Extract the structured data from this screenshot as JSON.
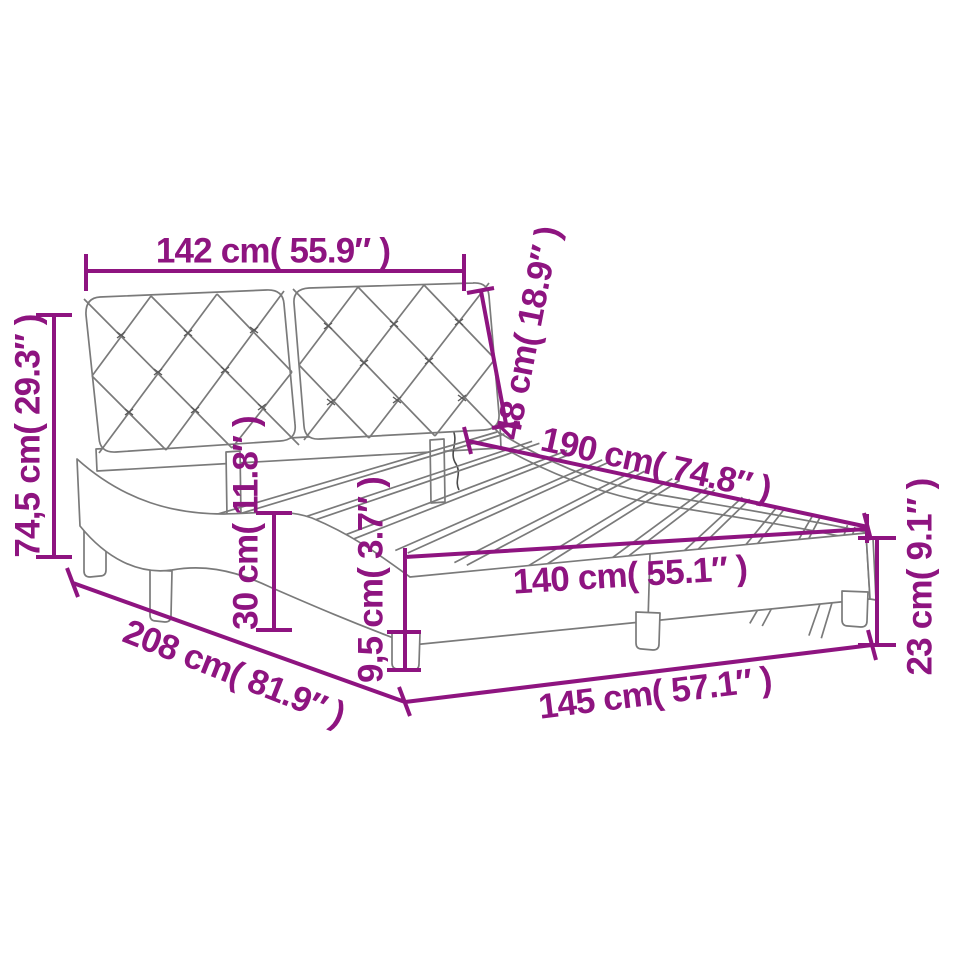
{
  "diagram": {
    "type": "furniture-dimension-diagram",
    "subject": "upholstered bed frame with two tufted headboard cushions, curved side rails, slatted base and legs",
    "accent_color": "#8e1480",
    "line_art_color": "#7a7a7a",
    "background_color": "#ffffff",
    "dimensions": {
      "headboard_width": {
        "label": "142 cm( 55.9″ )",
        "cm": "142",
        "inches": "55.9"
      },
      "headboard_height": {
        "label": "48 cm( 18.9″ )",
        "cm": "48",
        "inches": "18.9"
      },
      "total_height": {
        "label": "74,5 cm( 29.3″ )",
        "cm": "74,5",
        "inches": "29.3"
      },
      "mattress_length": {
        "label": "190 cm( 74.8″ )",
        "cm": "190",
        "inches": "74.8"
      },
      "total_length": {
        "label": "208 cm( 81.9″ )",
        "cm": "208",
        "inches": "81.9"
      },
      "mattress_width": {
        "label": "140 cm( 55.1″ )",
        "cm": "140",
        "inches": "55.1"
      },
      "total_width": {
        "label": "145 cm( 57.1″ )",
        "cm": "145",
        "inches": "57.1"
      },
      "base_height": {
        "label": "23 cm( 9.1″ )",
        "cm": "23",
        "inches": "9.1"
      },
      "rail_height": {
        "label": "30 cm( 11.8″ )",
        "cm": "30",
        "inches": "11.8"
      },
      "leg_height": {
        "label": "9,5 cm( 3.7″ )",
        "cm": "9,5",
        "inches": "3.7"
      }
    }
  }
}
